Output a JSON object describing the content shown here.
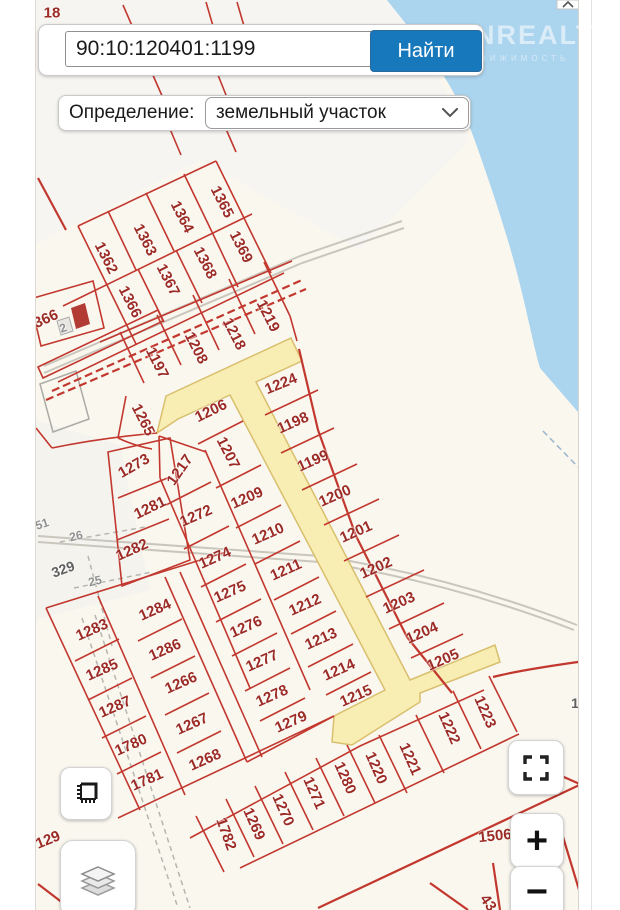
{
  "search": {
    "query": "90:10:120401:1199",
    "button_label": "Найти"
  },
  "filter": {
    "label": "Определение:",
    "selected_option": "земельный участок"
  },
  "watermark": {
    "title": "ONREALT",
    "subtitle": "НЕДВИЖИМОСТЬ"
  },
  "controls": {
    "zoom_in": "+",
    "zoom_out": "−"
  },
  "map": {
    "colors": {
      "accent_blue": "#1878bc",
      "line_red": "#c2382f",
      "label_red": "#9c2b25",
      "water": "#abd4ee",
      "highlight_road": "#f8edb2",
      "land": "#faf7ef"
    },
    "parcel_labels": [
      {
        "id": "1362",
        "x": 106,
        "y": 258,
        "rot": 63
      },
      {
        "id": "1363",
        "x": 145,
        "y": 240,
        "rot": 63
      },
      {
        "id": "1364",
        "x": 182,
        "y": 217,
        "rot": 63
      },
      {
        "id": "1365",
        "x": 222,
        "y": 202,
        "rot": 63
      },
      {
        "id": "1366",
        "x": 130,
        "y": 302,
        "rot": 63
      },
      {
        "id": "1367",
        "x": 168,
        "y": 280,
        "rot": 63
      },
      {
        "id": "1368",
        "x": 205,
        "y": 263,
        "rot": 63
      },
      {
        "id": "1369",
        "x": 241,
        "y": 247,
        "rot": 63
      },
      {
        "id": "1197",
        "x": 157,
        "y": 363,
        "rot": 63
      },
      {
        "id": "1208",
        "x": 196,
        "y": 348,
        "rot": 63
      },
      {
        "id": "1218",
        "x": 234,
        "y": 334,
        "rot": 63
      },
      {
        "id": "1219",
        "x": 268,
        "y": 316,
        "rot": 63
      },
      {
        "id": "1265",
        "x": 143,
        "y": 420,
        "rot": 63
      },
      {
        "id": "1206",
        "x": 211,
        "y": 411,
        "rot": -26
      },
      {
        "id": "1224",
        "x": 281,
        "y": 384,
        "rot": -22
      },
      {
        "id": "1198",
        "x": 293,
        "y": 423,
        "rot": -24
      },
      {
        "id": "1199",
        "x": 313,
        "y": 461,
        "rot": -24
      },
      {
        "id": "1200",
        "x": 335,
        "y": 496,
        "rot": -24
      },
      {
        "id": "1201",
        "x": 356,
        "y": 532,
        "rot": -24
      },
      {
        "id": "1202",
        "x": 376,
        "y": 568,
        "rot": -24
      },
      {
        "id": "1203",
        "x": 399,
        "y": 603,
        "rot": -24
      },
      {
        "id": "1204",
        "x": 422,
        "y": 633,
        "rot": -24
      },
      {
        "id": "1205",
        "x": 443,
        "y": 660,
        "rot": -24
      },
      {
        "id": "1207",
        "x": 228,
        "y": 453,
        "rot": 63
      },
      {
        "id": "1217",
        "x": 180,
        "y": 470,
        "rot": -55
      },
      {
        "id": "1209",
        "x": 247,
        "y": 498,
        "rot": -24
      },
      {
        "id": "1210",
        "x": 268,
        "y": 534,
        "rot": -24
      },
      {
        "id": "1211",
        "x": 286,
        "y": 570,
        "rot": -24
      },
      {
        "id": "1212",
        "x": 305,
        "y": 605,
        "rot": -24
      },
      {
        "id": "1213",
        "x": 321,
        "y": 639,
        "rot": -24
      },
      {
        "id": "1214",
        "x": 339,
        "y": 670,
        "rot": -24
      },
      {
        "id": "1215",
        "x": 356,
        "y": 696,
        "rot": -24
      },
      {
        "id": "1273",
        "x": 134,
        "y": 466,
        "rot": -30
      },
      {
        "id": "1281",
        "x": 150,
        "y": 508,
        "rot": -26
      },
      {
        "id": "1282",
        "x": 132,
        "y": 550,
        "rot": -24
      },
      {
        "id": "1272",
        "x": 196,
        "y": 516,
        "rot": -24
      },
      {
        "id": "1274",
        "x": 215,
        "y": 558,
        "rot": -24
      },
      {
        "id": "1275",
        "x": 230,
        "y": 592,
        "rot": -24
      },
      {
        "id": "1276",
        "x": 246,
        "y": 627,
        "rot": -24
      },
      {
        "id": "1277",
        "x": 262,
        "y": 661,
        "rot": -24
      },
      {
        "id": "1278",
        "x": 272,
        "y": 696,
        "rot": -24
      },
      {
        "id": "1279",
        "x": 291,
        "y": 722,
        "rot": -24
      },
      {
        "id": "1283",
        "x": 92,
        "y": 630,
        "rot": -24
      },
      {
        "id": "1284",
        "x": 155,
        "y": 610,
        "rot": -24
      },
      {
        "id": "1285",
        "x": 102,
        "y": 670,
        "rot": -24
      },
      {
        "id": "1286",
        "x": 165,
        "y": 650,
        "rot": -24
      },
      {
        "id": "1287",
        "x": 115,
        "y": 707,
        "rot": -24
      },
      {
        "id": "1266",
        "x": 181,
        "y": 683,
        "rot": -24
      },
      {
        "id": "1267",
        "x": 192,
        "y": 724,
        "rot": -24
      },
      {
        "id": "1780",
        "x": 131,
        "y": 745,
        "rot": -24
      },
      {
        "id": "1268",
        "x": 205,
        "y": 760,
        "rot": -24
      },
      {
        "id": "1781",
        "x": 147,
        "y": 780,
        "rot": -24
      },
      {
        "id": "1782",
        "x": 226,
        "y": 834,
        "rot": 70
      },
      {
        "id": "1269",
        "x": 254,
        "y": 824,
        "rot": 66
      },
      {
        "id": "1270",
        "x": 283,
        "y": 810,
        "rot": 66
      },
      {
        "id": "1271",
        "x": 314,
        "y": 793,
        "rot": 66
      },
      {
        "id": "1280",
        "x": 345,
        "y": 778,
        "rot": 66
      },
      {
        "id": "1220",
        "x": 376,
        "y": 768,
        "rot": 66
      },
      {
        "id": "1221",
        "x": 410,
        "y": 759,
        "rot": 66
      },
      {
        "id": "1222",
        "x": 449,
        "y": 728,
        "rot": 66
      },
      {
        "id": "1223",
        "x": 485,
        "y": 712,
        "rot": 66
      }
    ],
    "misc_labels": [
      {
        "text": "18",
        "x": 52,
        "y": 13,
        "rot": 0,
        "tone": "red"
      },
      {
        "text": "366",
        "x": 46,
        "y": 319,
        "rot": -24,
        "tone": "red"
      },
      {
        "text": "2",
        "x": 63,
        "y": 328,
        "rot": -20,
        "tone": "grey"
      },
      {
        "text": "51",
        "x": 42,
        "y": 524,
        "rot": -18,
        "tone": "grey"
      },
      {
        "text": "26",
        "x": 76,
        "y": 536,
        "rot": -14,
        "tone": "grey"
      },
      {
        "text": "329",
        "x": 63,
        "y": 569,
        "rot": -20,
        "tone": "dark"
      },
      {
        "text": "25",
        "x": 95,
        "y": 581,
        "rot": -14,
        "tone": "grey"
      },
      {
        "text": "129",
        "x": 48,
        "y": 840,
        "rot": -22,
        "tone": "red"
      },
      {
        "text": "1506",
        "x": 495,
        "y": 836,
        "rot": -6,
        "tone": "red"
      },
      {
        "text": "1",
        "x": 575,
        "y": 703,
        "rot": 0,
        "tone": "dark"
      },
      {
        "text": "43",
        "x": 488,
        "y": 903,
        "rot": 55,
        "tone": "red"
      }
    ]
  }
}
